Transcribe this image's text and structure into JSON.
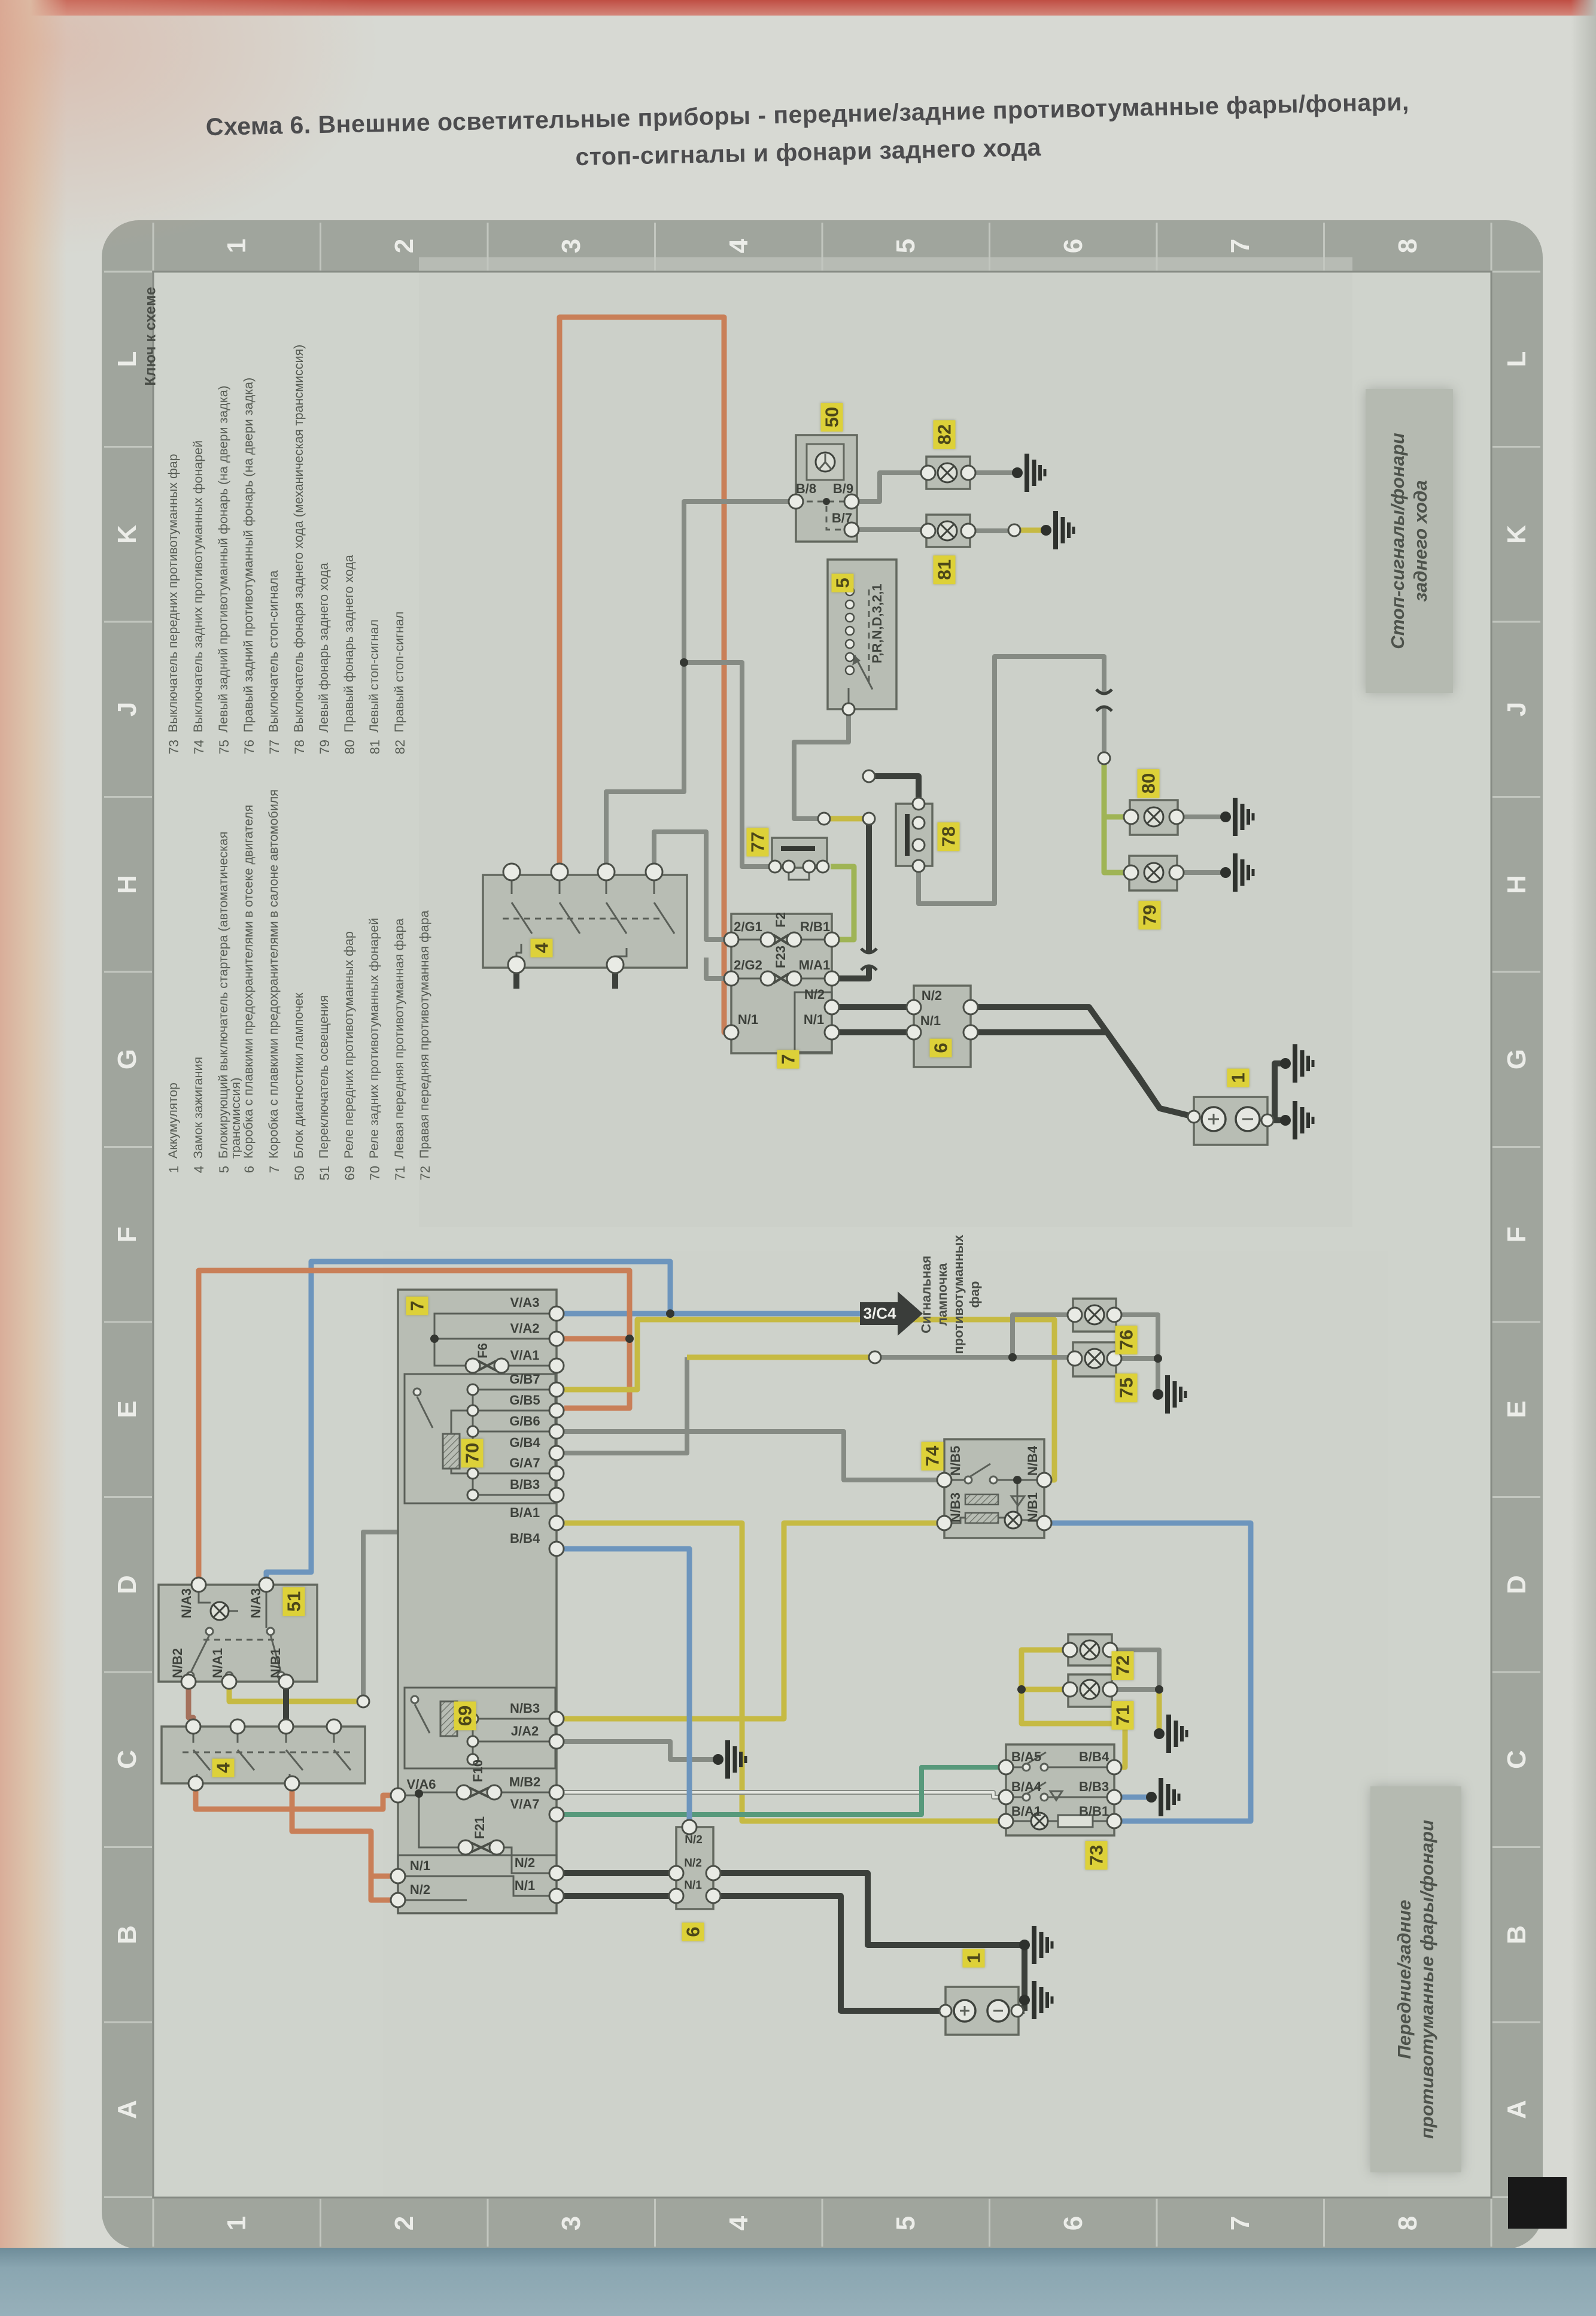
{
  "page": {
    "title_line1": "Схема 6. Внешние осветительные приборы - передние/задние противотуманные фары/фонари,",
    "title_line2": "стоп-сигналы и фонари заднего хода",
    "corner_marker": "C"
  },
  "grid": {
    "columns": [
      "1",
      "2",
      "3",
      "4",
      "5",
      "6",
      "7",
      "8"
    ],
    "rows": [
      "L",
      "K",
      "J",
      "H",
      "G",
      "F",
      "E",
      "D",
      "C",
      "B",
      "A"
    ]
  },
  "legend": {
    "heading": "Ключ к схеме",
    "items_fog_stop": [
      {
        "num": "73",
        "text": "Выключатель передних противотуманных фар"
      },
      {
        "num": "74",
        "text": "Выключатель задних противотуманных фонарей"
      },
      {
        "num": "75",
        "text": "Левый задний противотуманный фонарь (на двери задка)"
      },
      {
        "num": "76",
        "text": "Правый задний противотуманный фонарь (на двери задка)"
      },
      {
        "num": "77",
        "text": "Выключатель стоп-сигнала"
      },
      {
        "num": "78",
        "text": "Выключатель фонаря заднего хода (механическая трансмиссия)"
      },
      {
        "num": "79",
        "text": "Левый фонарь заднего хода"
      },
      {
        "num": "80",
        "text": "Правый фонарь заднего хода"
      },
      {
        "num": "81",
        "text": "Левый стоп-сигнал"
      },
      {
        "num": "82",
        "text": "Правый стоп-сигнал"
      }
    ],
    "items_main": [
      {
        "num": "1",
        "text": "Аккумулятор"
      },
      {
        "num": "4",
        "text": "Замок зажигания"
      },
      {
        "num": "5",
        "text": "Блокирующий выключатель стартера (автоматическая трансмиссия)"
      },
      {
        "num": "6",
        "text": "Коробка с плавкими предохранителями в отсеке двигателя"
      },
      {
        "num": "7",
        "text": "Коробка с плавкими предохранителями в салоне автомобиля"
      },
      {
        "num": "50",
        "text": "Блок диагностики лампочек"
      },
      {
        "num": "51",
        "text": "Переключатель освещения"
      },
      {
        "num": "69",
        "text": "Реле передних противотуманных фар"
      },
      {
        "num": "70",
        "text": "Реле задних противотуманных фонарей"
      },
      {
        "num": "71",
        "text": "Левая передняя противотуманная фара"
      },
      {
        "num": "72",
        "text": "Правая передняя противотуманная фара"
      }
    ]
  },
  "side_labels": {
    "stop_line1": "Стоп-сигналы/фонари",
    "stop_line2": "заднего хода",
    "fog_line1": "Передние/задние",
    "fog_line2": "противотуманные фары/фонари"
  },
  "note_lines": [
    "Сигнальная",
    "лампочка",
    "противотуманных",
    "фар"
  ],
  "arrow": {
    "text": "3/C4"
  },
  "labels": {
    "u50": "50",
    "u82": "82",
    "u81": "81",
    "u5": "5",
    "u77": "77",
    "u78": "78",
    "u80": "80",
    "u79": "79",
    "u7": "7",
    "u6": "6",
    "u1": "1",
    "u4": "4",
    "l7": "7",
    "l70": "70",
    "l69": "69",
    "l51": "51",
    "l4": "4",
    "l74": "74",
    "l73": "73",
    "l76": "76",
    "l75": "75",
    "l72": "72",
    "l71": "71",
    "l6": "6",
    "l1": "1"
  },
  "pins": {
    "b8": "B/8",
    "b9": "B/9",
    "b7": "B/7",
    "g1": "2/G1",
    "f2": "F2",
    "rb1": "R/B1",
    "g2": "2/G2",
    "f23": "F23",
    "ma1": "M/A1",
    "n2": "N/2",
    "n1": "N/1",
    "prnd": "P,R,N,D,3,2,1",
    "va3": "V/A3",
    "va2": "V/A2",
    "va1": "V/A1",
    "gb7": "G/B7",
    "gb5": "G/B5",
    "gb6": "G/B6",
    "gb4": "G/B4",
    "ga7": "G/A7",
    "bb3": "B/B3",
    "ba1": "B/A1",
    "bb4": "B/B4",
    "nb3": "N/B3",
    "ja2": "J/A2",
    "mb2": "M/B2",
    "va7": "V/A7",
    "va6": "V/A6",
    "f6": "F6",
    "f10": "F10",
    "f21": "F21",
    "na3": "N/A3",
    "nb2": "N/B2",
    "na1": "N/A1",
    "nb1": "N/B1",
    "nb5": "N/B5",
    "nb4": "N/B4",
    "ba5": "B/A5",
    "ba4": "B/A4",
    "bb1": "B/B1"
  },
  "colors": {
    "paper": "#d6d8d2",
    "frame_band": "#a0a59d",
    "component_fill": "#b8bdb4",
    "label_yellow": "#ddd139",
    "wire_dark": "#3c403b",
    "wire_gray": "#868b84",
    "wire_orange": "#c97f58",
    "wire_yellow": "#c6ba43",
    "wire_green": "#9fb455",
    "wire_blue": "#6d95bd",
    "wire_brown": "#a5715c",
    "wire_teal": "#57997b",
    "book_edge_red": "#bf4f44",
    "book_bottom_blue": "#8aa6b1"
  }
}
